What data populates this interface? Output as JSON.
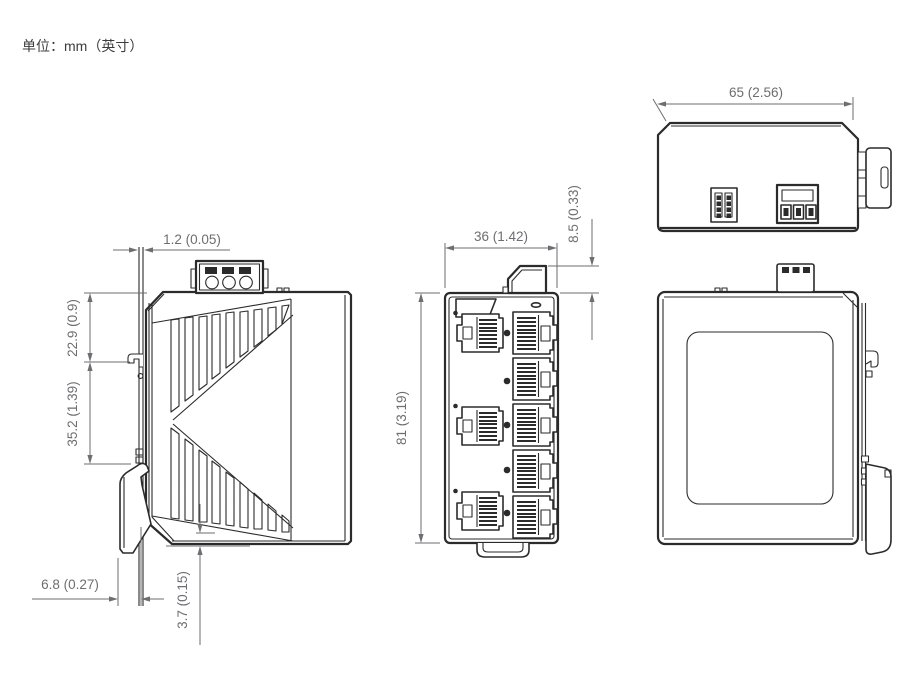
{
  "page": {
    "unit_label": "单位：mm（英寸）"
  },
  "colors": {
    "outline": "#2b2b2b",
    "dimension": "#6d6e71",
    "background": "#ffffff"
  },
  "views": {
    "left_side": {
      "label": "left-side-view",
      "dims": {
        "din_rail_thickness": "1.2 (0.05)",
        "top_to_hook": "22.9 (0.9)",
        "hook_span": "35.2 (1.39)",
        "clip_depth": "6.8 (0.27)",
        "bottom_clearance": "3.7 (0.15)"
      }
    },
    "front": {
      "label": "front-view",
      "ethernet_ports_left_column": 3,
      "ethernet_ports_right_column": 5,
      "status_led_count": 5,
      "dims": {
        "width": "36 (1.42)",
        "height": "81 (3.19)",
        "terminal_protrusion": "8.5 (0.33)"
      }
    },
    "top": {
      "label": "top-view",
      "dims": {
        "depth": "65 (2.56)"
      }
    },
    "right_side": {
      "label": "right-side-view"
    }
  }
}
